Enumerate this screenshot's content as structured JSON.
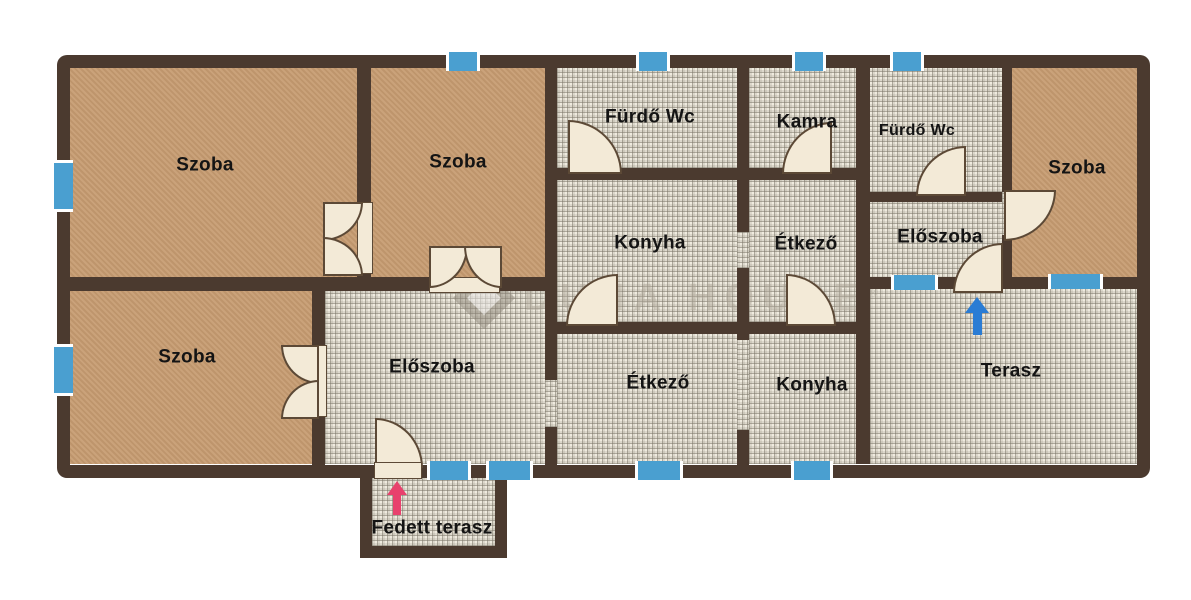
{
  "watermark": {
    "text": "DUNA HOUSE",
    "reg": "®"
  },
  "rooms": {
    "szoba_top_left": "Szoba",
    "szoba_top_mid": "Szoba",
    "furdo_wc_main": "Fürdő Wc",
    "kamra": "Kamra",
    "furdo_wc_small": "Fürdő Wc",
    "szoba_right": "Szoba",
    "konyha_top": "Konyha",
    "etkezo_top": "Étkező",
    "eloszoba_right": "Előszoba",
    "szoba_bottom_left": "Szoba",
    "eloszoba_center": "Előszoba",
    "etkezo_bottom": "Étkező",
    "konyha_bottom": "Konyha",
    "terasz": "Terasz",
    "fedett_terasz": "Fedett terasz"
  },
  "colors": {
    "wall": "#4b3a2f",
    "floor_brown": "#c69b70",
    "tile_base": "#efebdf",
    "window_blue": "#4a9fd0",
    "door_cream": "#f3ead7",
    "arrow_blue": "#2a7cd4",
    "arrow_pink": "#e8416d",
    "label": "#141414"
  },
  "icons": {
    "terrace_entrance": "arrow-up-icon",
    "covered_terrace_entrance": "arrow-up-icon",
    "brand_logo": "duna-house-diamond"
  }
}
